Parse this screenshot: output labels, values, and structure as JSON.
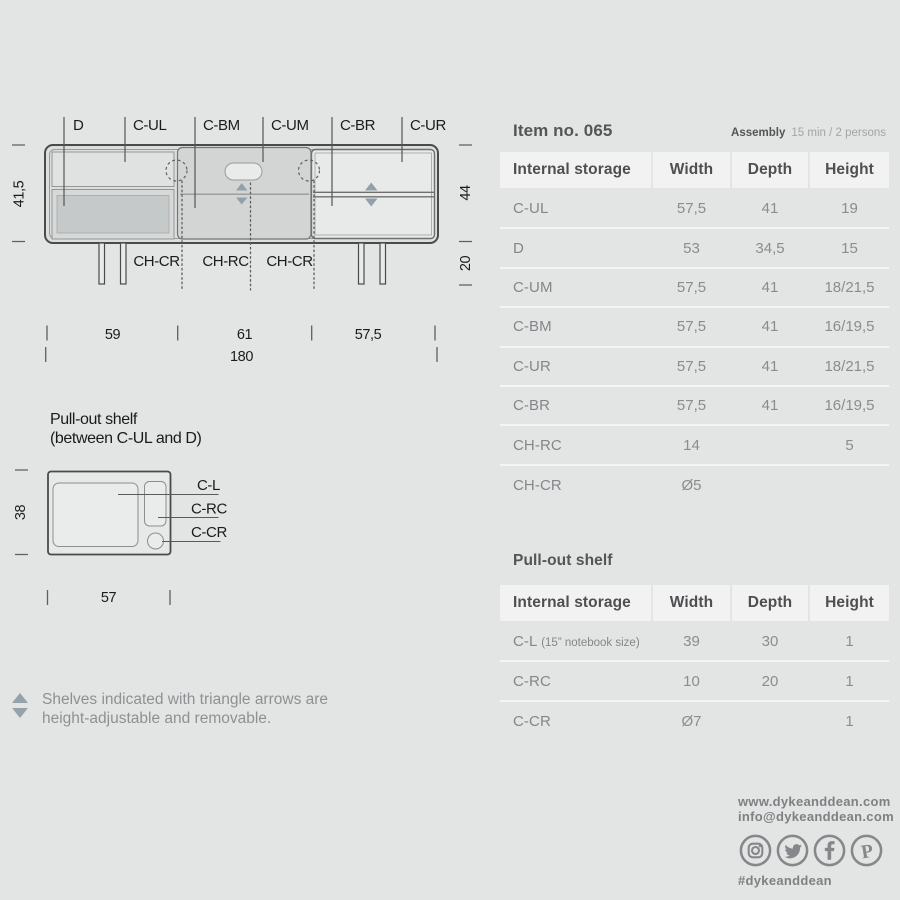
{
  "drawing": {
    "compartment_labels": [
      "D",
      "C-UL",
      "C-BM",
      "C-UM",
      "C-BR",
      "C-UR"
    ],
    "hole_labels": [
      "CH-CR",
      "CH-RC",
      "CH-CR"
    ],
    "dim_internal_height": "41,5",
    "dim_body_height": "44",
    "dim_leg_height": "20",
    "dim_section_widths": [
      "59",
      "61",
      "57,5"
    ],
    "dim_total_width": "180"
  },
  "shelf_drawing": {
    "title_line1": "Pull-out shelf",
    "title_line2": "(between C-UL and D)",
    "labels": [
      "C-L",
      "C-RC",
      "C-CR"
    ],
    "dim_depth": "38",
    "dim_width": "57"
  },
  "note": {
    "line1": "Shelves indicated with triangle arrows are",
    "line2": "height-adjustable and removable."
  },
  "spec": {
    "item_title": "Item no. 065",
    "assembly_label": "Assembly",
    "assembly_value": "15 min / 2 persons",
    "columns": [
      "Internal storage",
      "Width",
      "Depth",
      "Height"
    ],
    "rows": [
      {
        "name": "C-UL",
        "width": "57,5",
        "depth": "41",
        "height": "19"
      },
      {
        "name": "D",
        "width": "53",
        "depth": "34,5",
        "height": "15"
      },
      {
        "name": "C-UM",
        "width": "57,5",
        "depth": "41",
        "height": "18/21,5"
      },
      {
        "name": "C-BM",
        "width": "57,5",
        "depth": "41",
        "height": "16/19,5"
      },
      {
        "name": "C-UR",
        "width": "57,5",
        "depth": "41",
        "height": "18/21,5"
      },
      {
        "name": "C-BR",
        "width": "57,5",
        "depth": "41",
        "height": "16/19,5"
      },
      {
        "name": "CH-RC",
        "width": "14",
        "depth": "",
        "height": "5"
      },
      {
        "name": "CH-CR",
        "width": "Ø5",
        "depth": "",
        "height": ""
      }
    ]
  },
  "shelf_spec": {
    "title": "Pull-out shelf",
    "columns": [
      "Internal storage",
      "Width",
      "Depth",
      "Height"
    ],
    "rows": [
      {
        "name": "C-L",
        "name_note": "(15” notebook size)",
        "width": "39",
        "depth": "30",
        "height": "1"
      },
      {
        "name": "C-RC",
        "name_note": "",
        "width": "10",
        "depth": "20",
        "height": "1"
      },
      {
        "name": "C-CR",
        "name_note": "",
        "width": "Ø7",
        "depth": "",
        "height": "1"
      }
    ]
  },
  "footer": {
    "website": "www.dykeanddean.com",
    "email": "info@dykeanddean.com",
    "hashtag": "#dykeanddean",
    "social_icons": [
      "instagram",
      "twitter",
      "facebook",
      "pinterest"
    ]
  },
  "colors": {
    "page_bg": "#e3e4e4",
    "line_dark": "#4a4a4a",
    "line_light": "#989898",
    "arrow_blue_gray": "#93a0ab",
    "header_cell_bg": "#f2f2f3",
    "row_separator": "#f4f5f5",
    "heading_text": "#545557",
    "value_text": "#8b8c8e",
    "footer_text": "#7f8083"
  }
}
